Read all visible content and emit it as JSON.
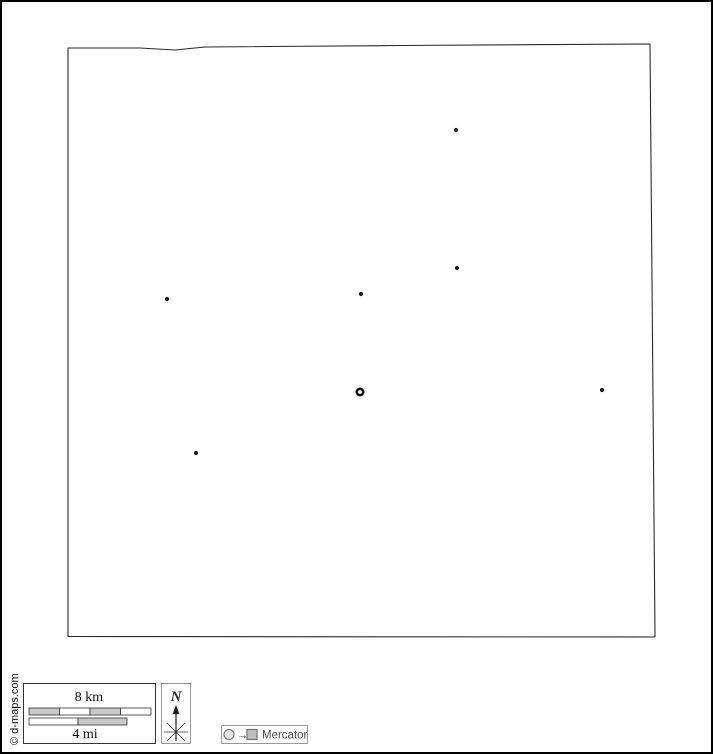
{
  "page": {
    "background": "#ffffff",
    "frame_color": "#000000"
  },
  "map": {
    "outline_color": "#2a2a2a",
    "dot_color": "#1c1c1c",
    "city_dot_radius": 2.1,
    "outline": [
      [
        68,
        48
      ],
      [
        140,
        48
      ],
      [
        175,
        50
      ],
      [
        205,
        47
      ],
      [
        400,
        45.5
      ],
      [
        650,
        44
      ],
      [
        652.5,
        340
      ],
      [
        655,
        637
      ],
      [
        68,
        636.5
      ]
    ],
    "cities": [
      {
        "x": 456,
        "y": 130
      },
      {
        "x": 457,
        "y": 268
      },
      {
        "x": 361,
        "y": 294
      },
      {
        "x": 167,
        "y": 299
      },
      {
        "x": 602,
        "y": 390
      },
      {
        "x": 196,
        "y": 453
      }
    ],
    "capital": {
      "x": 360,
      "y": 392,
      "radius": 3.2,
      "ring_width": 2.6,
      "ring_color": "#111111",
      "hole_color": "#ffffff"
    }
  },
  "scale_bar": {
    "km_label": "8 km",
    "mi_label": "4 mi",
    "border_color": "#333333",
    "segment_stroke": "#333333",
    "gray_fill": "#c8c8c8",
    "white_fill": "#ffffff",
    "km_bar": {
      "x": 29,
      "y": 708,
      "width": 122,
      "height": 7,
      "segment_colors": [
        "#c8c8c8",
        "#ffffff",
        "#c8c8c8",
        "#ffffff"
      ]
    },
    "mi_bar": {
      "x": 29,
      "y": 718,
      "width": 98,
      "height": 7,
      "segment_colors": [
        "#ffffff",
        "#c8c8c8"
      ]
    }
  },
  "compass": {
    "label": "N",
    "box_border_color": "#999999",
    "arrow_color": "#1a1a1a",
    "cross_color": "#333333",
    "horizontal_ray_color": "#999999"
  },
  "projection": {
    "label": "Mercator",
    "arrow": "→",
    "box_border_color": "#999999",
    "circle_stroke": "#808080",
    "circle_fill": "#e3e3e3",
    "square_stroke": "#737373",
    "square_fill": "#bfbfbf"
  },
  "credit": {
    "text": "© d-maps.com"
  }
}
